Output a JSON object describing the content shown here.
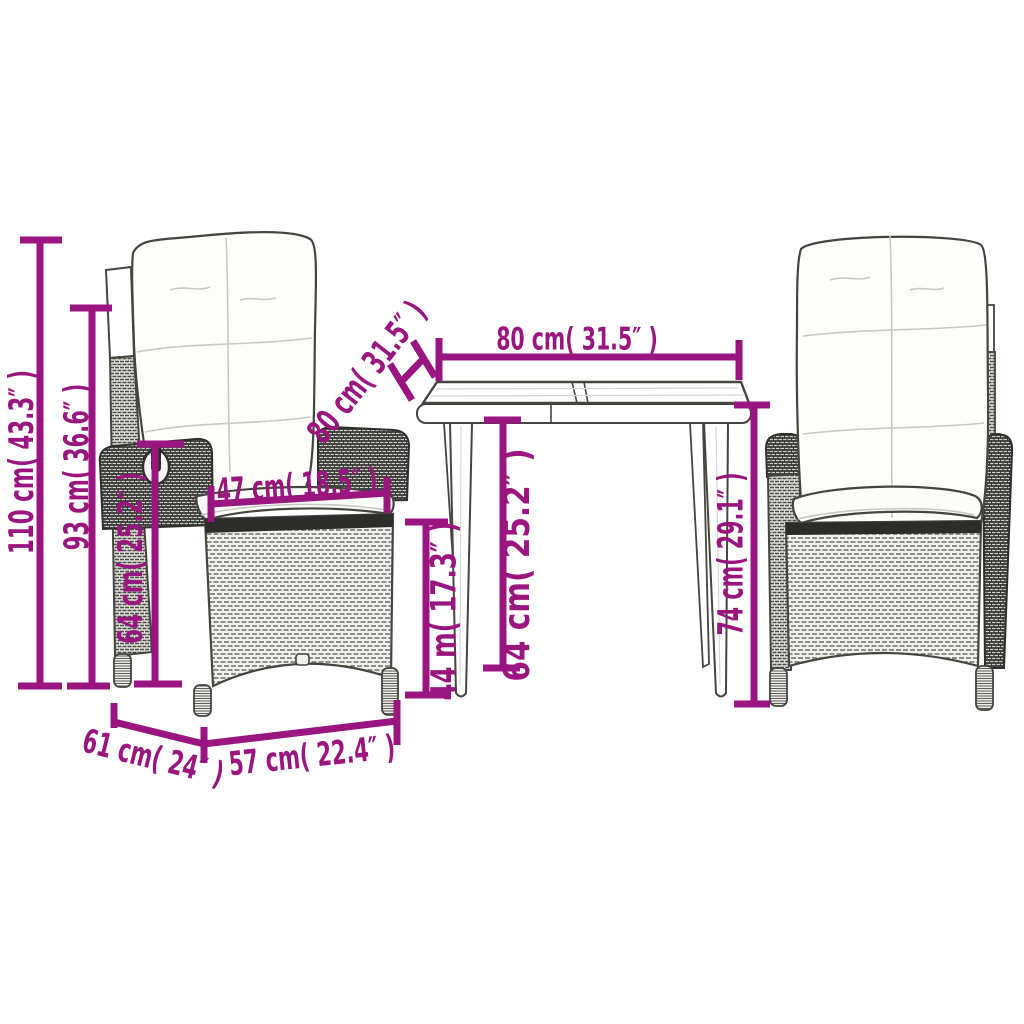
{
  "image_type": "product-dimension-diagram",
  "product_scene": {
    "left_chair": "reclining wicker garden chair with cushions (side view)",
    "table": "garden dining table (front view)",
    "right_chair": "reclining wicker garden chair with cushions (front view)"
  },
  "colors": {
    "accent": "#9A1580",
    "ink": "#45443F"
  },
  "dimensions": {
    "chair_total_height": "110 cm( 43.3″ )",
    "chair_back_height": "93 cm( 36.6″ )",
    "chair_armrest_height": "64 cm( 25.2″ )",
    "chair_seat_width": "47 cm( 18.5″ )",
    "table_depth": "80 cm( 31.5″ )",
    "table_width": "80 cm( 31.5″ )",
    "table_leg_height": "64 cm( 25.2″ )",
    "table_clearance_height": "44 m( 17.3″ )",
    "table_height": "74 cm( 29.1″ )",
    "chair_depth": "61 cm( 24″ )",
    "chair_seat_base_width": "57 cm( 22.4″ )"
  }
}
